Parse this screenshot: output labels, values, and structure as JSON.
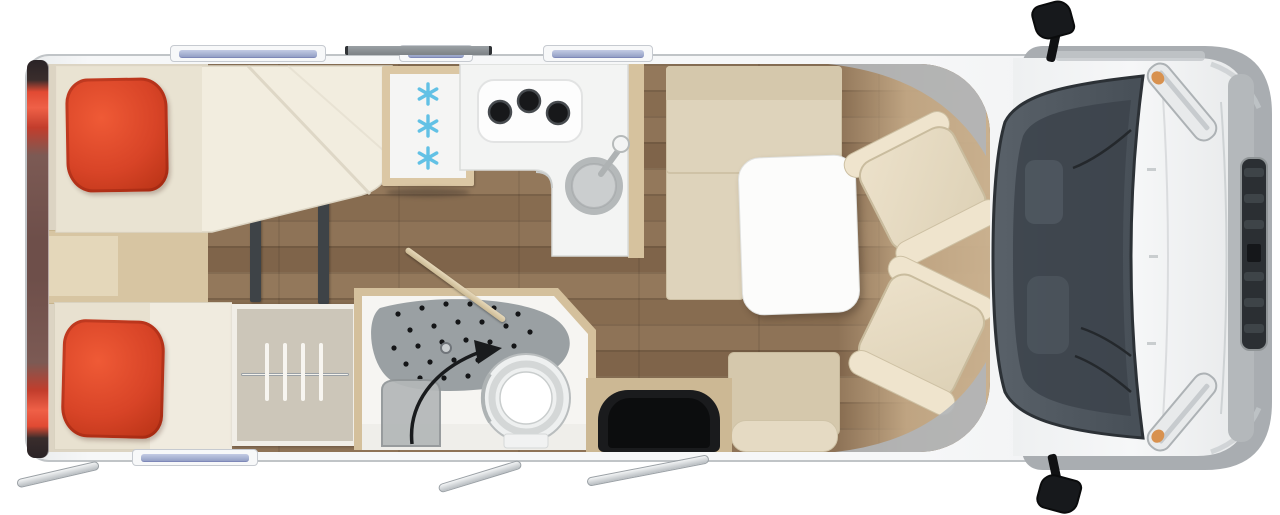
{
  "scene": {
    "type": "motorhome top-down floor plan (3D render)",
    "background": "#ffffff",
    "vehicle_front": "right",
    "vehicle_rear": "left"
  },
  "palette": {
    "bg": "#ffffff",
    "body-edge": "#c0c4c7",
    "cab-gray": "#a9adb1",
    "floor-bedroom": "#dcd4c3",
    "mattress": "#e8e1d0",
    "duvet": "#f2eddf",
    "pillow-red": "#d84427",
    "cushion": "#ded3bb",
    "cushion-dark": "#d5c8ac",
    "seat-cream": "#e9dec7",
    "table-white": "#fcfcfb",
    "counter-white": "#f3f4f3",
    "burner-black": "#17181a",
    "sink-gray": "#b5b9ba",
    "fridge-frame": "#dbc7a4",
    "snowflake-blue": "#62c1e5",
    "shower-gray": "#9aa0a3",
    "toilet-white": "#f6f7f7",
    "mat-black": "#1a1b1d",
    "windshield": "#555d65",
    "grille-dark": "#2b2f33",
    "glass-blue": "#a9b3d4",
    "taillight-red": "#e14a33",
    "wall-tan": "#d4c09c",
    "hanger-white": "#f7f5f0",
    "arrow-black": "#191b1d"
  },
  "zones": {
    "bedroom": {
      "location": "rear (left side of plan)",
      "single_beds": 2,
      "red_pillows": 2,
      "duvet_folded_diagonally": true,
      "between_bed_cabinet": true,
      "partition_tracks": 2,
      "wardrobe_hangers": 4
    },
    "kitchen": {
      "counter_shape": "L",
      "fridge_snowflakes": 3,
      "hob_burners": 3,
      "sink_with_faucet": true
    },
    "bathroom": {
      "shower_floor_dotted": true,
      "floor_drain": true,
      "toilet": true,
      "shower_seat": true,
      "swivel_wall_arrow": true,
      "door_open_diagonal": true
    },
    "lounge": {
      "l_shaped_bench": true,
      "white_table": true,
      "side_bench_seat": true,
      "entry_door_mat": true
    },
    "cab": {
      "swivel_captain_seats": 2,
      "windshield": true,
      "wiper_arms": 2,
      "wing_mirrors": 2,
      "headlights": 2,
      "amber_indicators": 2,
      "front_grille": true
    }
  },
  "exterior": {
    "windows_top_wall": 3,
    "windows_bottom_wall": 1,
    "roof_strip_over_kitchen": 1,
    "rear_taillight_bar": true,
    "taillights_red": 2,
    "awning_rails_below_body": 3
  }
}
